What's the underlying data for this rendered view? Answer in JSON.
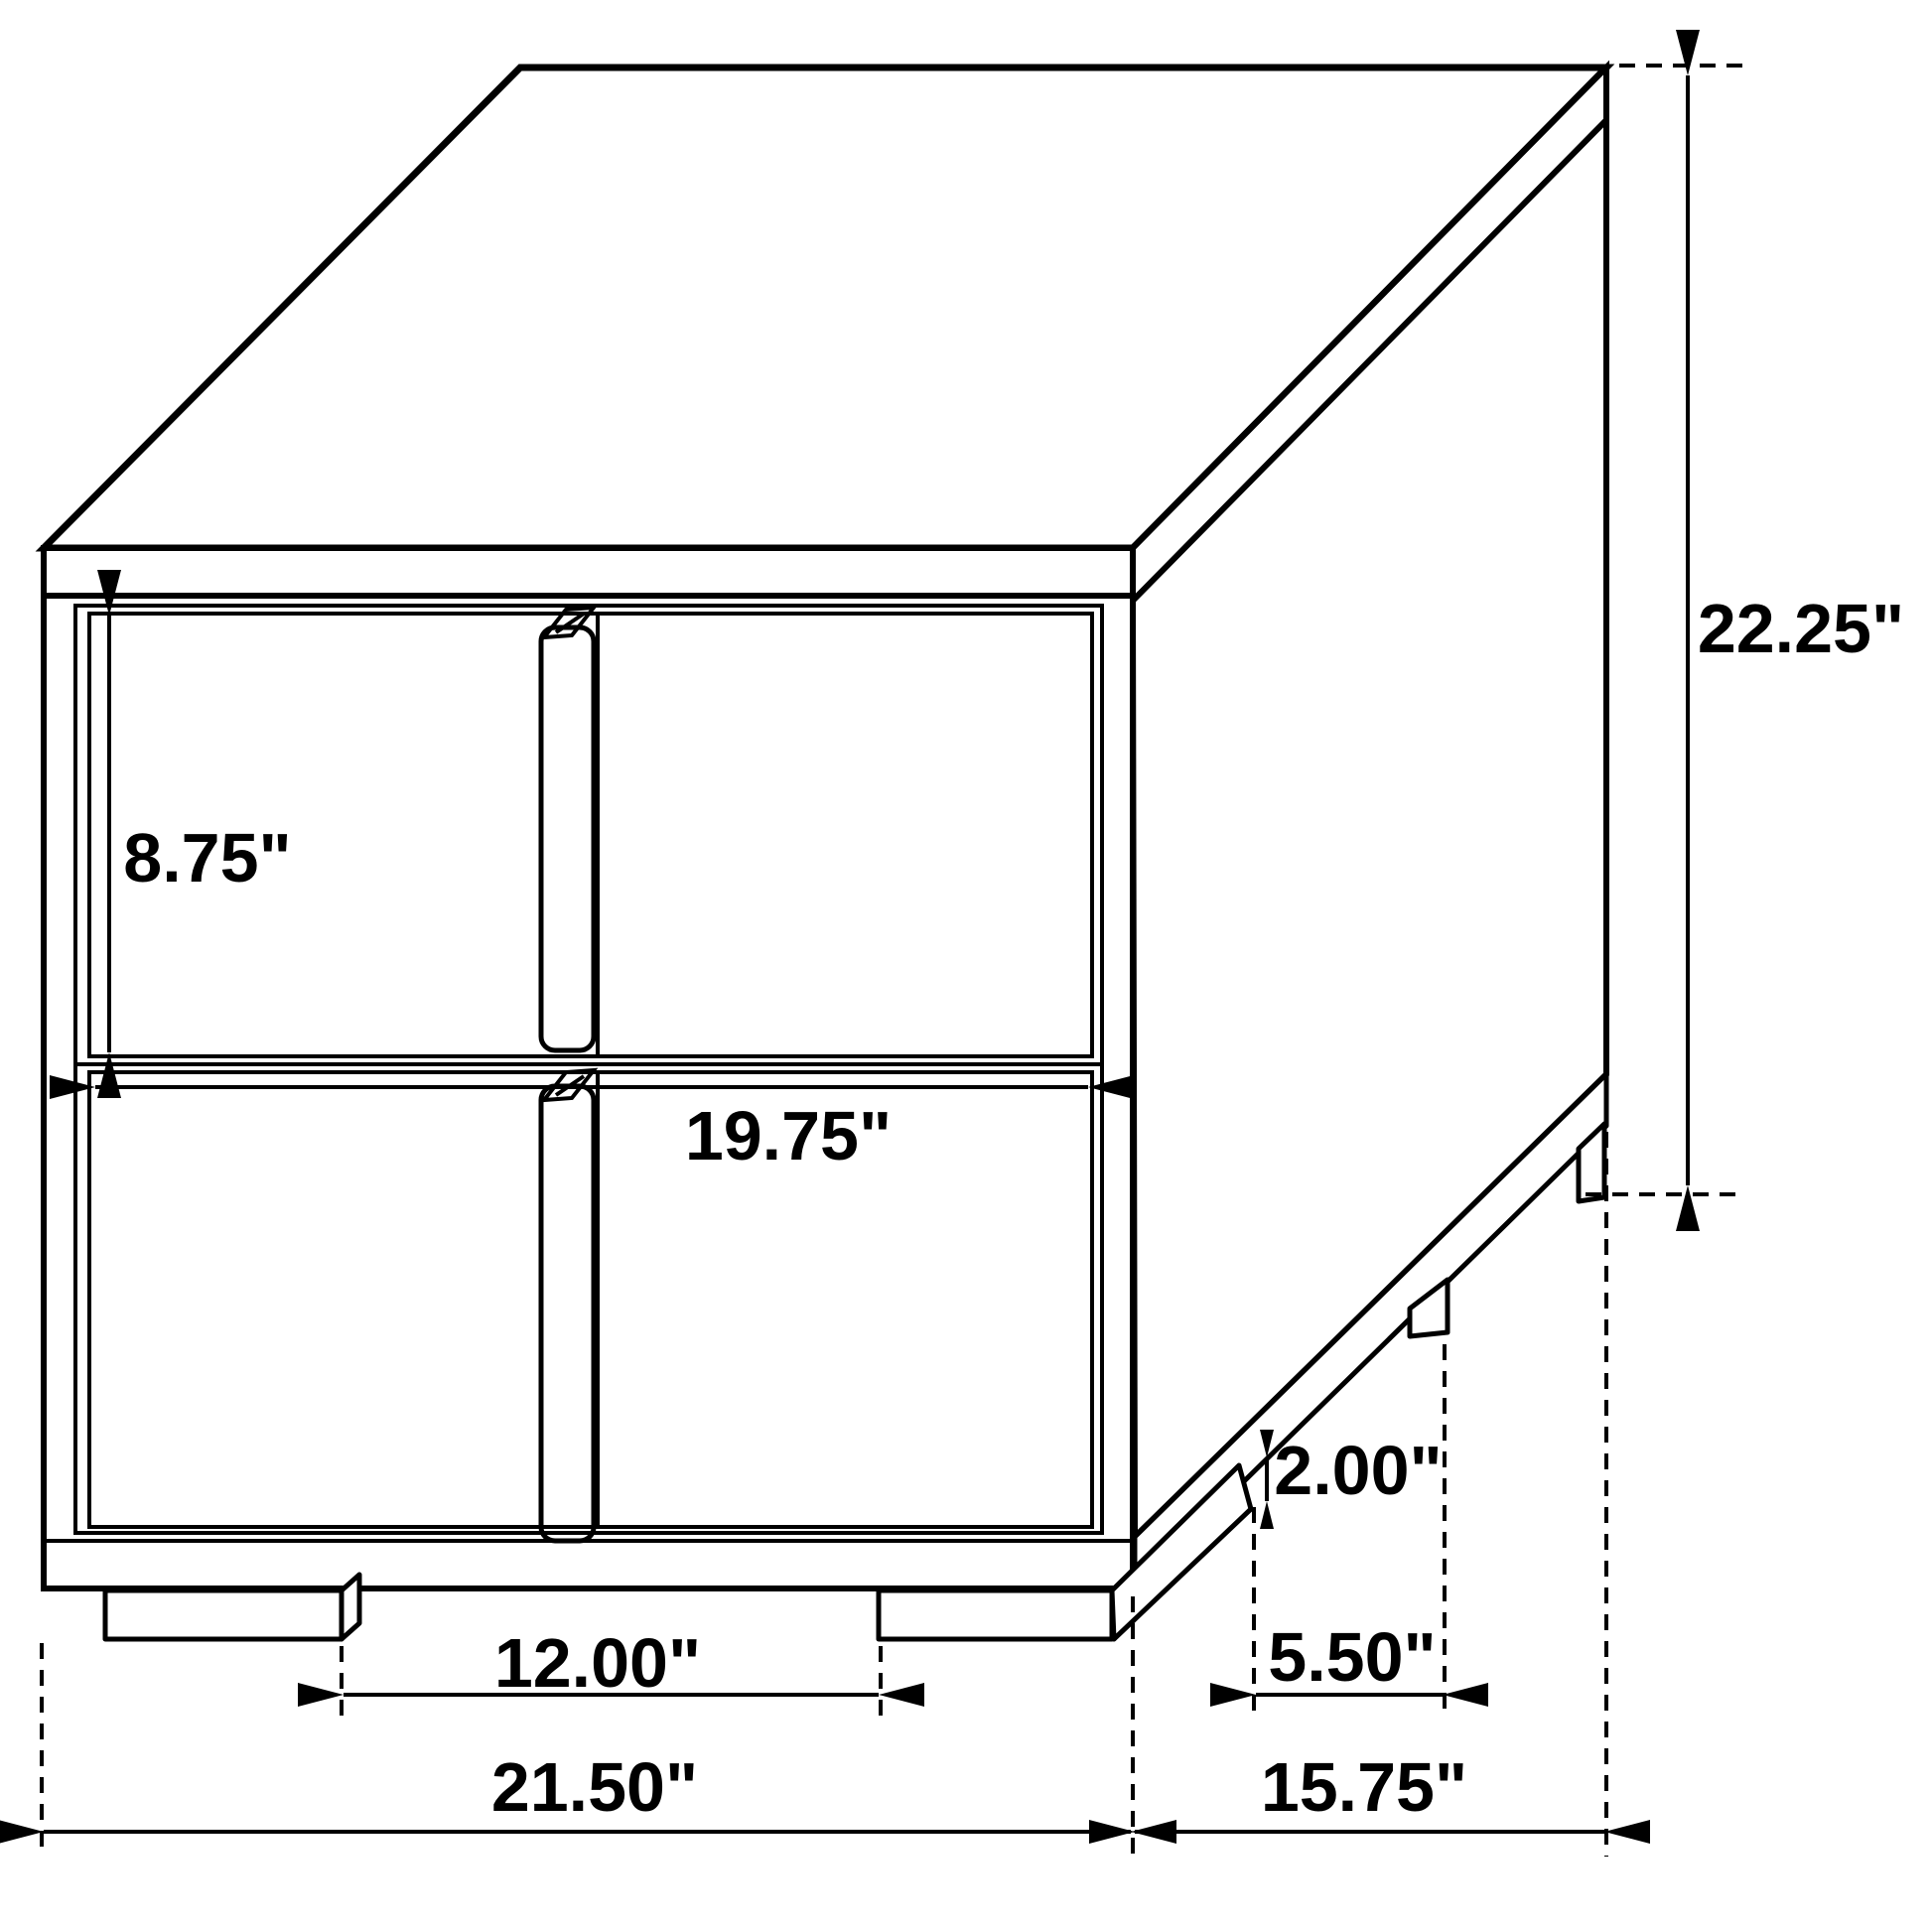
{
  "page": {
    "title": "Nightstand dimension diagram",
    "background_color": "#ffffff",
    "line_color": "#000000"
  },
  "dimensions": {
    "drawer_height": "8.75\"",
    "drawer_width": "19.75\"",
    "total_height": "22.25\"",
    "foot_height": "2.00\"",
    "side_foot_spacing": "5.50\"",
    "front_foot_spacing": "12.00\"",
    "total_width": "21.50\"",
    "total_depth": "15.75\""
  }
}
